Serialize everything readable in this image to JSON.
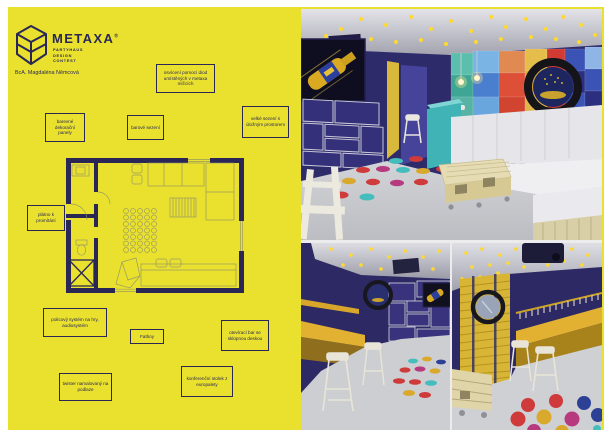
{
  "logo": {
    "brand": "METAXA",
    "registered_mark": "®",
    "subtitle_line1": "PARTYHAUS",
    "subtitle_line2": "DESIGN",
    "subtitle_line3": "CONTEST"
  },
  "author": "BcA. Magdaléna Němcová",
  "annotations": {
    "lighting": "osvícení pomocí diod umístěných v metaxa míčcích",
    "decor_panels": "barevné dekorační panely",
    "bar_seating": "barové sezení",
    "large_seating": "velké sezení s úložným prostorem",
    "projection_screen": "plátno k promítání",
    "shelf_system": "policový systém na hry, audiosystém",
    "fatboy": "Fatboy",
    "folding_bar": "otevírací bar se sklopnou deskou",
    "twister_floor": "twister namalovaný na podlaze",
    "pallet_table": "konferenční stolek z europalety"
  },
  "colors": {
    "board_yellow": "#e9e12e",
    "ink_navy": "#2a2757",
    "render_wall_navy": "#2e2b6b",
    "ceiling_grey": "#c9c9d0",
    "led_yellow": "#ffd92b",
    "bar_gold": "#d9a62c",
    "counter_teal": "#3fb3b5",
    "sofa_white": "#e9e9ec",
    "pallet_wood": "#e6dcb4",
    "twister_red": "#cf3a3a",
    "twister_yellow": "#d8a92c",
    "twister_teal": "#45bdbd",
    "twister_magenta": "#b73a7f",
    "twister_blue": "#2c4096"
  }
}
